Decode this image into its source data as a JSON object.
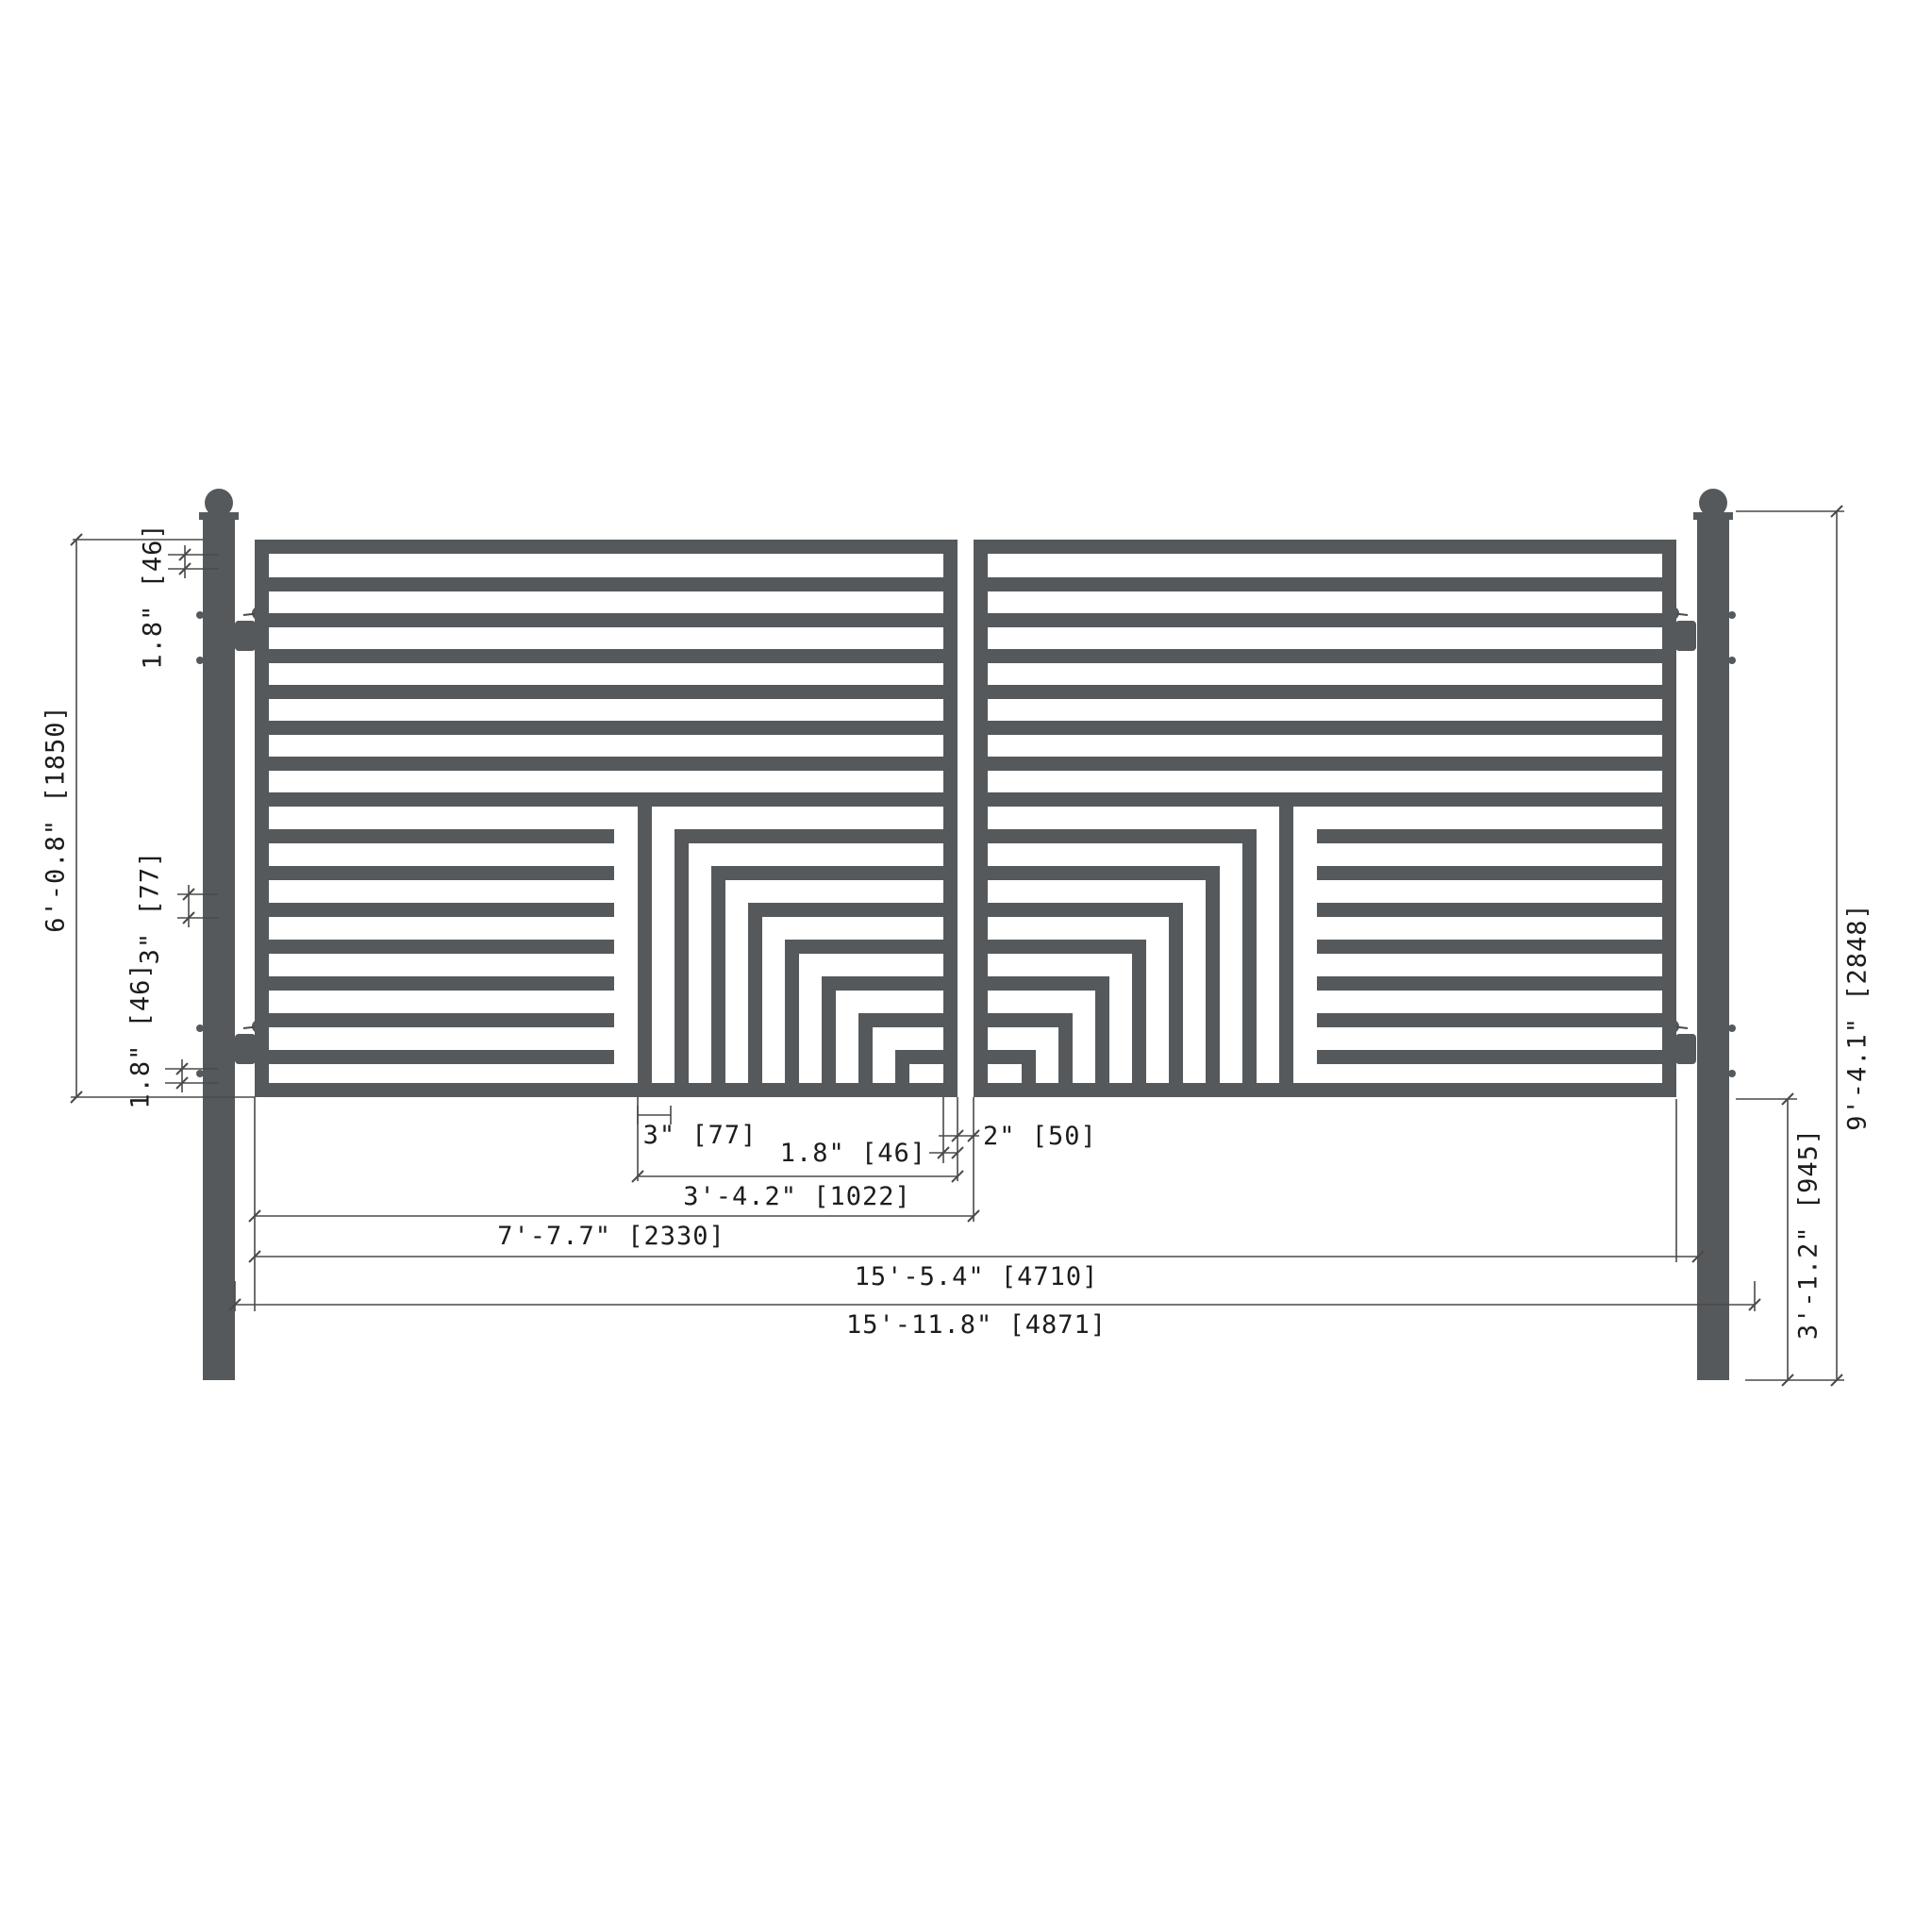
{
  "drawing": {
    "type": "dual-swing-driveway-gate-dimensioned-elevation",
    "colors": {
      "steel": "#55595c",
      "dimension_line": "#4a4a4a",
      "text": "#1c1c1c",
      "background": "#ffffff"
    },
    "structure": {
      "panels": 2,
      "posts": 2,
      "top_full_width_bars_per_panel": 6,
      "lower_half_bars_per_panel": 7,
      "corner_pattern_rings_per_panel": 8,
      "hinges_per_post": 2
    },
    "dimensions": {
      "left_top_gap": "1.8\"  [46]",
      "panel_height": "6'-0.8\"  [1850]",
      "bar_spacing": "3\"  [77]",
      "left_bottom_gap": "1.8\"  [46]",
      "post_height": "9'-4.1\"  [2848]",
      "ground_clearance": "3'-1.2\"  [945]",
      "pattern_spacing": "3\"  [77]",
      "frame_tube": "1.8\"  [46]",
      "center_gap": "2\"  [50]",
      "pattern_width": "3'-4.2\"  [1022]",
      "leaf_width": "7'-7.7\"  [2330]",
      "gates_width": "15'-5.4\"  [4710]",
      "overall_width": "15'-11.8\"  [4871]"
    }
  }
}
